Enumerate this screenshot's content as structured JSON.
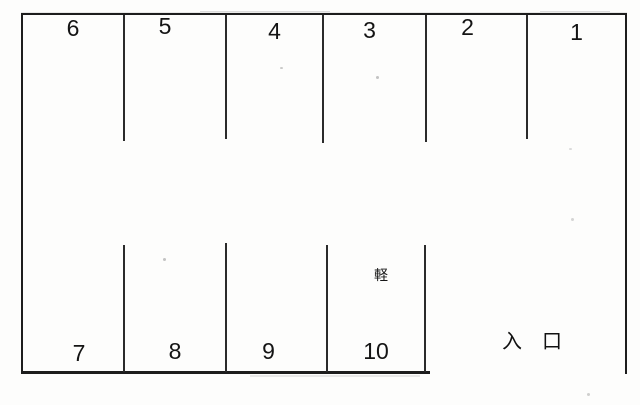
{
  "diagram": {
    "kind": "parking-lot-layout",
    "background_color": "#fdfdfc",
    "line_color": "#1d1d1d",
    "text_color": "#141414",
    "top_row": [
      {
        "label": "6"
      },
      {
        "label": "5"
      },
      {
        "label": "4"
      },
      {
        "label": "3"
      },
      {
        "label": "2"
      },
      {
        "label": "1"
      }
    ],
    "bottom_row": [
      {
        "label": "7"
      },
      {
        "label": "8"
      },
      {
        "label": "9"
      },
      {
        "label": "10"
      }
    ],
    "kei_label": "軽",
    "entrance_label": "入　口"
  }
}
